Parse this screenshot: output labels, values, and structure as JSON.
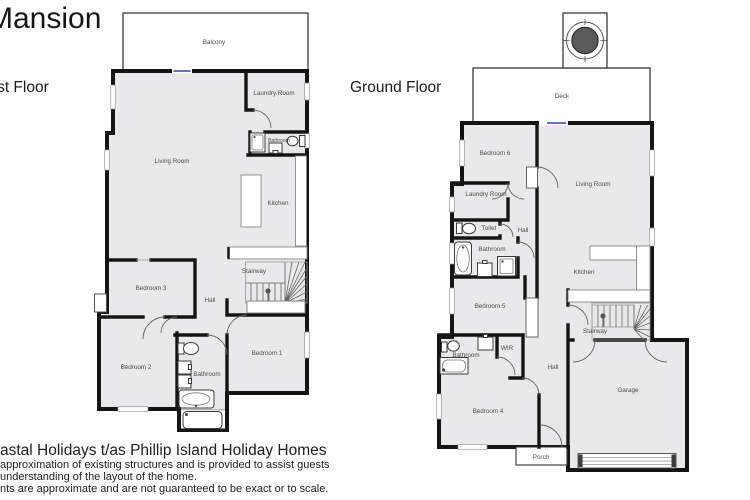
{
  "title": "Mansion",
  "floors": {
    "first": {
      "heading": "First Floor",
      "rooms": {
        "balcony": "Balcony",
        "laundry": "Laundry Room",
        "bathroom_upper": "Bathroom",
        "living": "Living Room",
        "kitchen": "Kitchen",
        "stairway": "Stairway",
        "hall": "Hall",
        "bedroom3": "Bedroom 3",
        "bedroom2": "Bedroom 2",
        "bathroom_lower": "Bathroom",
        "bedroom1": "Bedroom 1"
      }
    },
    "ground": {
      "heading": "Ground Floor",
      "rooms": {
        "deck": "Deck",
        "bedroom6": "Bedroom 6",
        "living": "Living Room",
        "laundry": "Laundry Room",
        "toilet": "Toilet",
        "hall_upper": "Hall",
        "bathroom_upper": "Bathroom",
        "bedroom5": "Bedroom 5",
        "kitchen": "Kitchen",
        "stairway": "Stairway",
        "wir": "WIR",
        "bathroom_lower": "Bathroom",
        "hall_lower": "Hall",
        "garage": "Garage",
        "bedroom4": "Bedroom 4",
        "porch": "Porch"
      }
    }
  },
  "footer": {
    "company_line": "astal Holidays t/as Phillip Island Holiday Homes",
    "disclaimer_line1": "approximation of existing structures and is provided to assist guests",
    "disclaimer_line2": "understanding of the layout of the home.",
    "disclaimer_line3": "nts are approximate and are not guaranteed to be exact or to scale."
  },
  "colors": {
    "wall": "#141414",
    "room_fill": "#e9e9eb",
    "label_text": "#4c4c4c",
    "slider_door": "#4d5bc0",
    "spa_fill": "#595959"
  }
}
